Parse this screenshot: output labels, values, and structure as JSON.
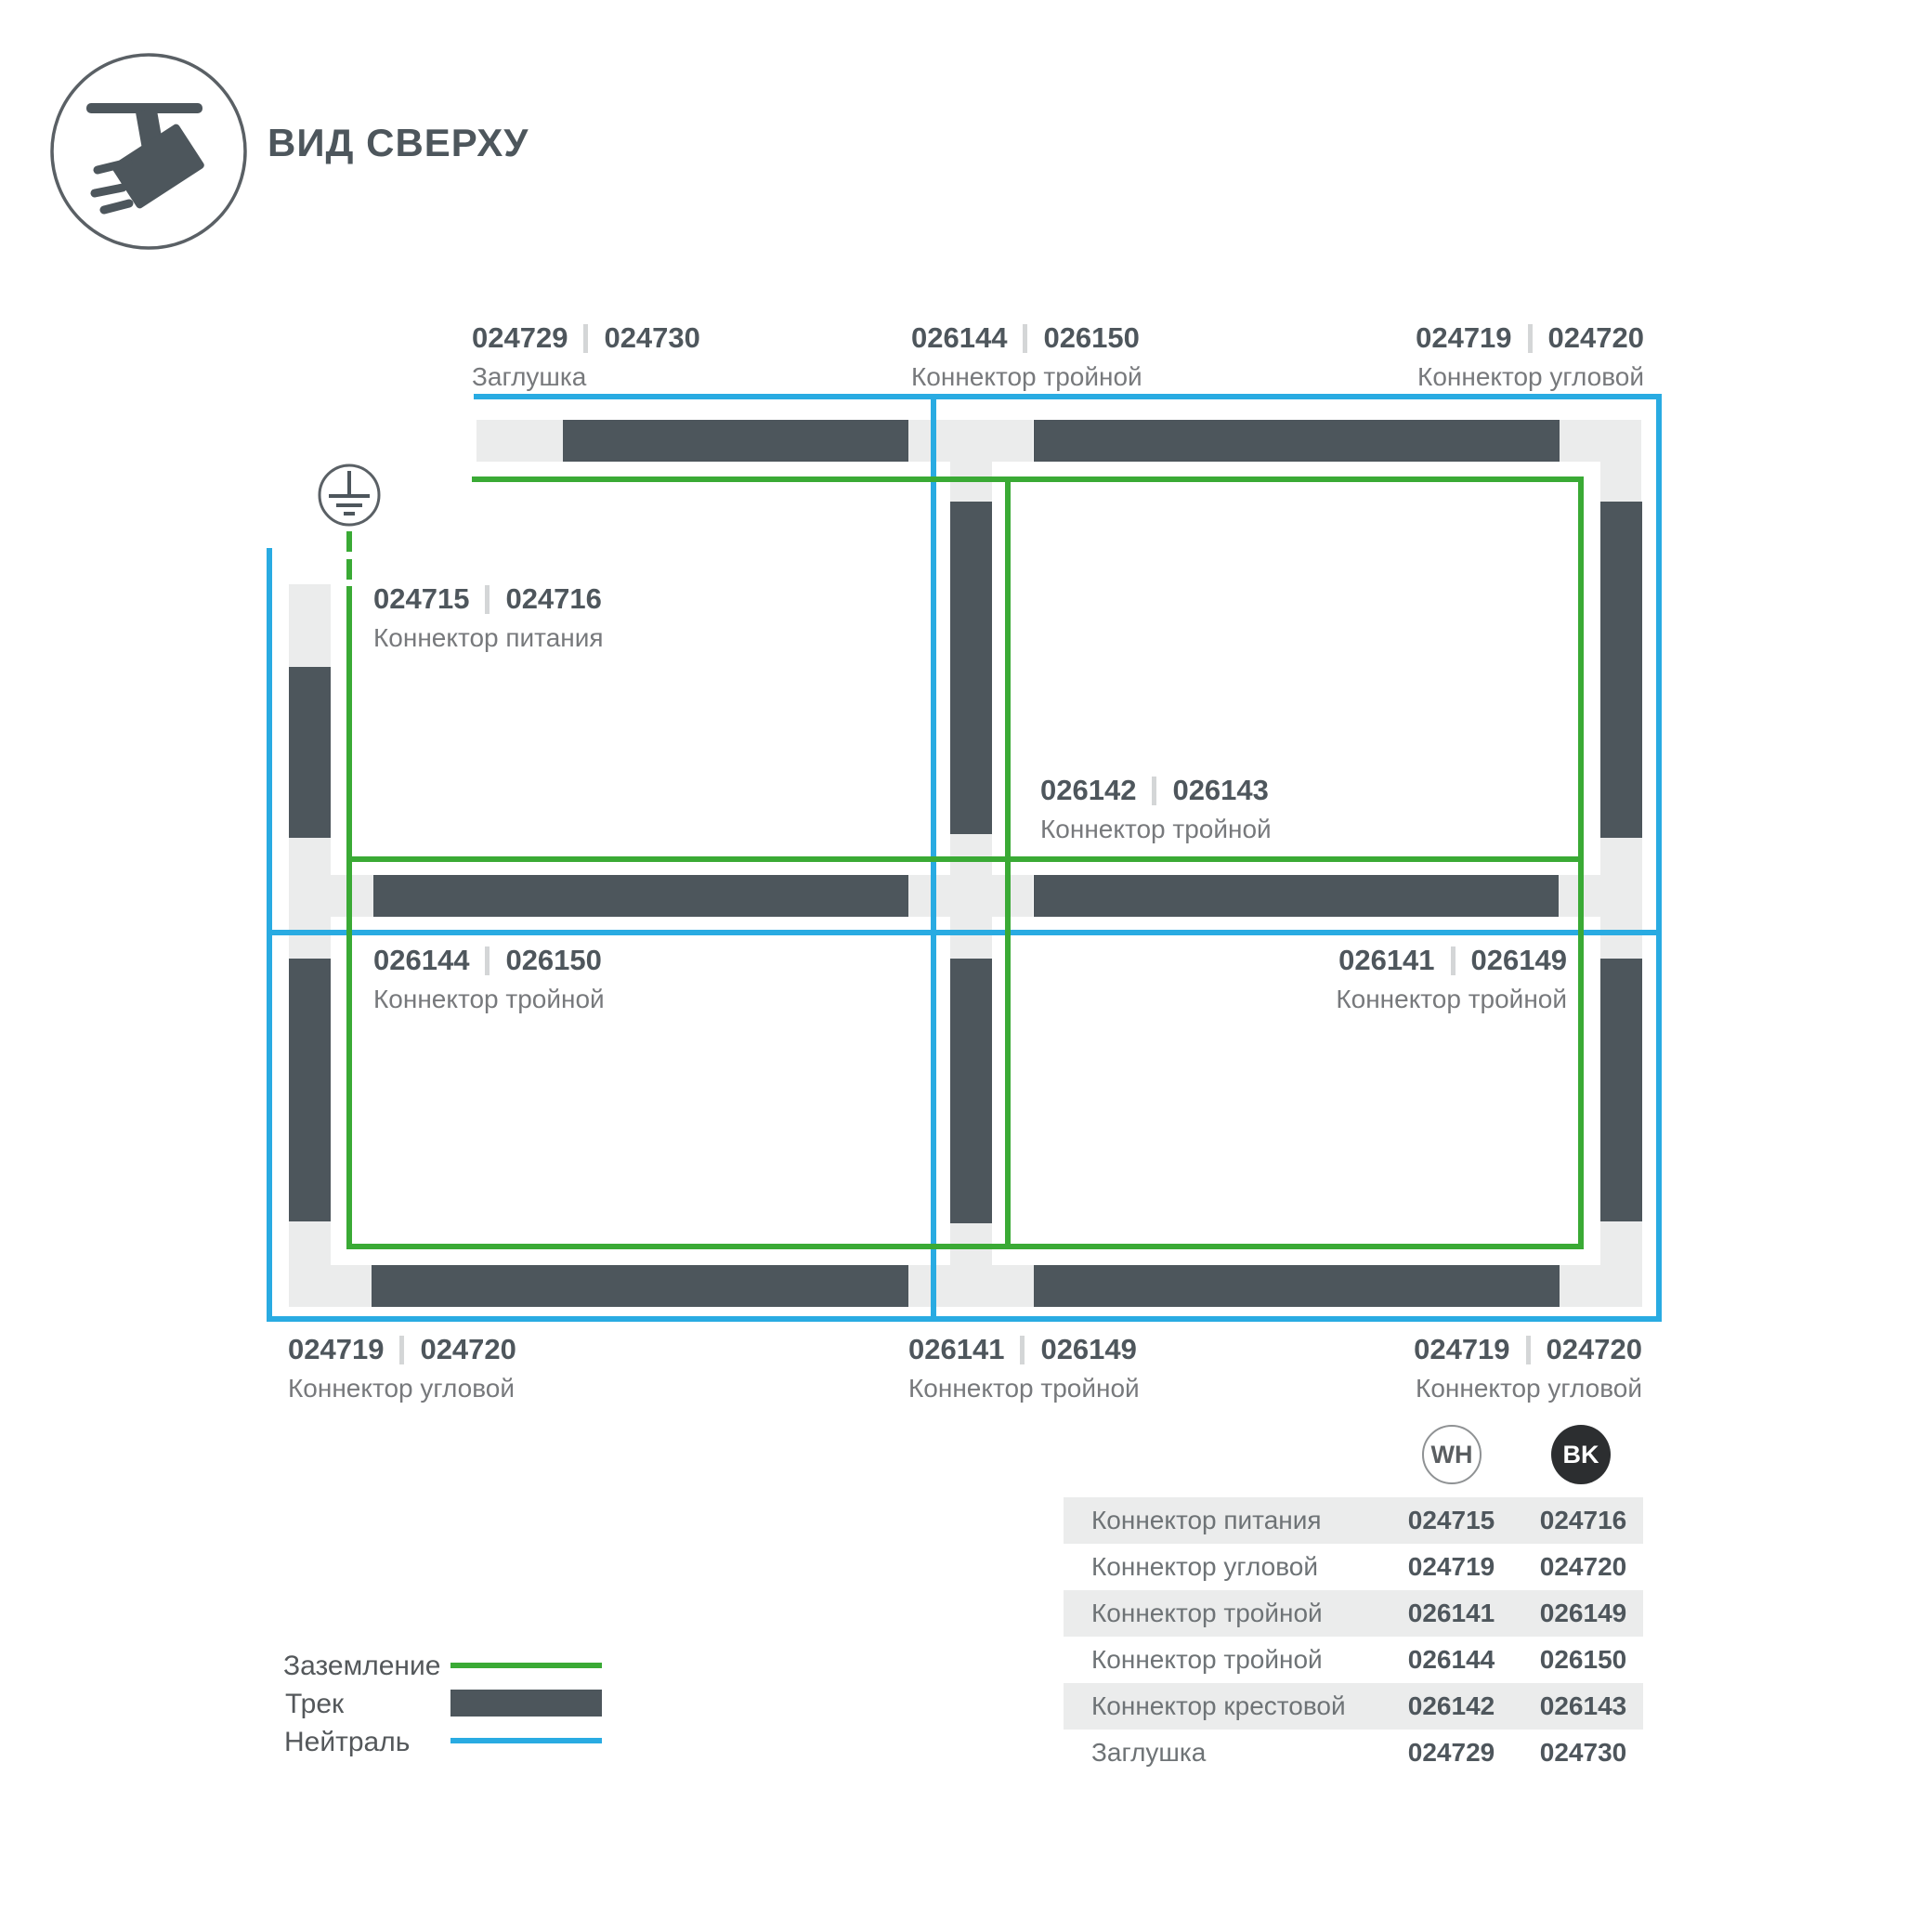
{
  "header": {
    "title": "ВИД СВЕРХУ",
    "icon": "track-spotlight-icon"
  },
  "diagram": {
    "ground_icon": "ground-earth-icon",
    "labels": [
      {
        "id": "top-endcap",
        "code_left": "024729",
        "code_right": "024730",
        "name": "Заглушка"
      },
      {
        "id": "top-tee",
        "code_left": "026144",
        "code_right": "026150",
        "name": "Коннектор тройной"
      },
      {
        "id": "top-corner",
        "code_left": "024719",
        "code_right": "024720",
        "name": "Коннектор угловой"
      },
      {
        "id": "power-feed",
        "code_left": "024715",
        "code_right": "024716",
        "name": "Коннектор питания"
      },
      {
        "id": "center-cross",
        "code_left": "026142",
        "code_right": "026143",
        "name": "Коннектор тройной"
      },
      {
        "id": "mid-left-tee",
        "code_left": "026144",
        "code_right": "026150",
        "name": "Коннектор тройной"
      },
      {
        "id": "mid-right-tee",
        "code_left": "026141",
        "code_right": "026149",
        "name": "Коннектор тройной"
      },
      {
        "id": "bottom-left-corner",
        "code_left": "024719",
        "code_right": "024720",
        "name": "Коннектор угловой"
      },
      {
        "id": "bottom-tee",
        "code_left": "026141",
        "code_right": "026149",
        "name": "Коннектор тройной"
      },
      {
        "id": "bottom-right-corner",
        "code_left": "024719",
        "code_right": "024720",
        "name": "Коннектор угловой"
      }
    ]
  },
  "legend": {
    "items": [
      {
        "label": "Заземление",
        "swatch": "ground-line-green"
      },
      {
        "label": "Трек",
        "swatch": "track-bar-dark"
      },
      {
        "label": "Нейтраль",
        "swatch": "neutral-line-blue"
      }
    ]
  },
  "table": {
    "col_badges": [
      {
        "label": "WH",
        "style": "outline"
      },
      {
        "label": "BK",
        "style": "filled"
      }
    ],
    "rows": [
      {
        "name": "Коннектор питания",
        "wh": "024715",
        "bk": "024716"
      },
      {
        "name": "Коннектор угловой",
        "wh": "024719",
        "bk": "024720"
      },
      {
        "name": "Коннектор тройной",
        "wh": "026141",
        "bk": "026149"
      },
      {
        "name": "Коннектор тройной",
        "wh": "026144",
        "bk": "026150"
      },
      {
        "name": "Коннектор крестовой",
        "wh": "026142",
        "bk": "026143"
      },
      {
        "name": "Заглушка",
        "wh": "024729",
        "bk": "024730"
      }
    ]
  },
  "colors": {
    "track": "#4d565c",
    "connector_light": "#ebecec",
    "ground_green": "#3aaa35",
    "neutral_blue": "#29abe2",
    "text_dark": "#4e565c",
    "text_gray": "#77797c"
  }
}
